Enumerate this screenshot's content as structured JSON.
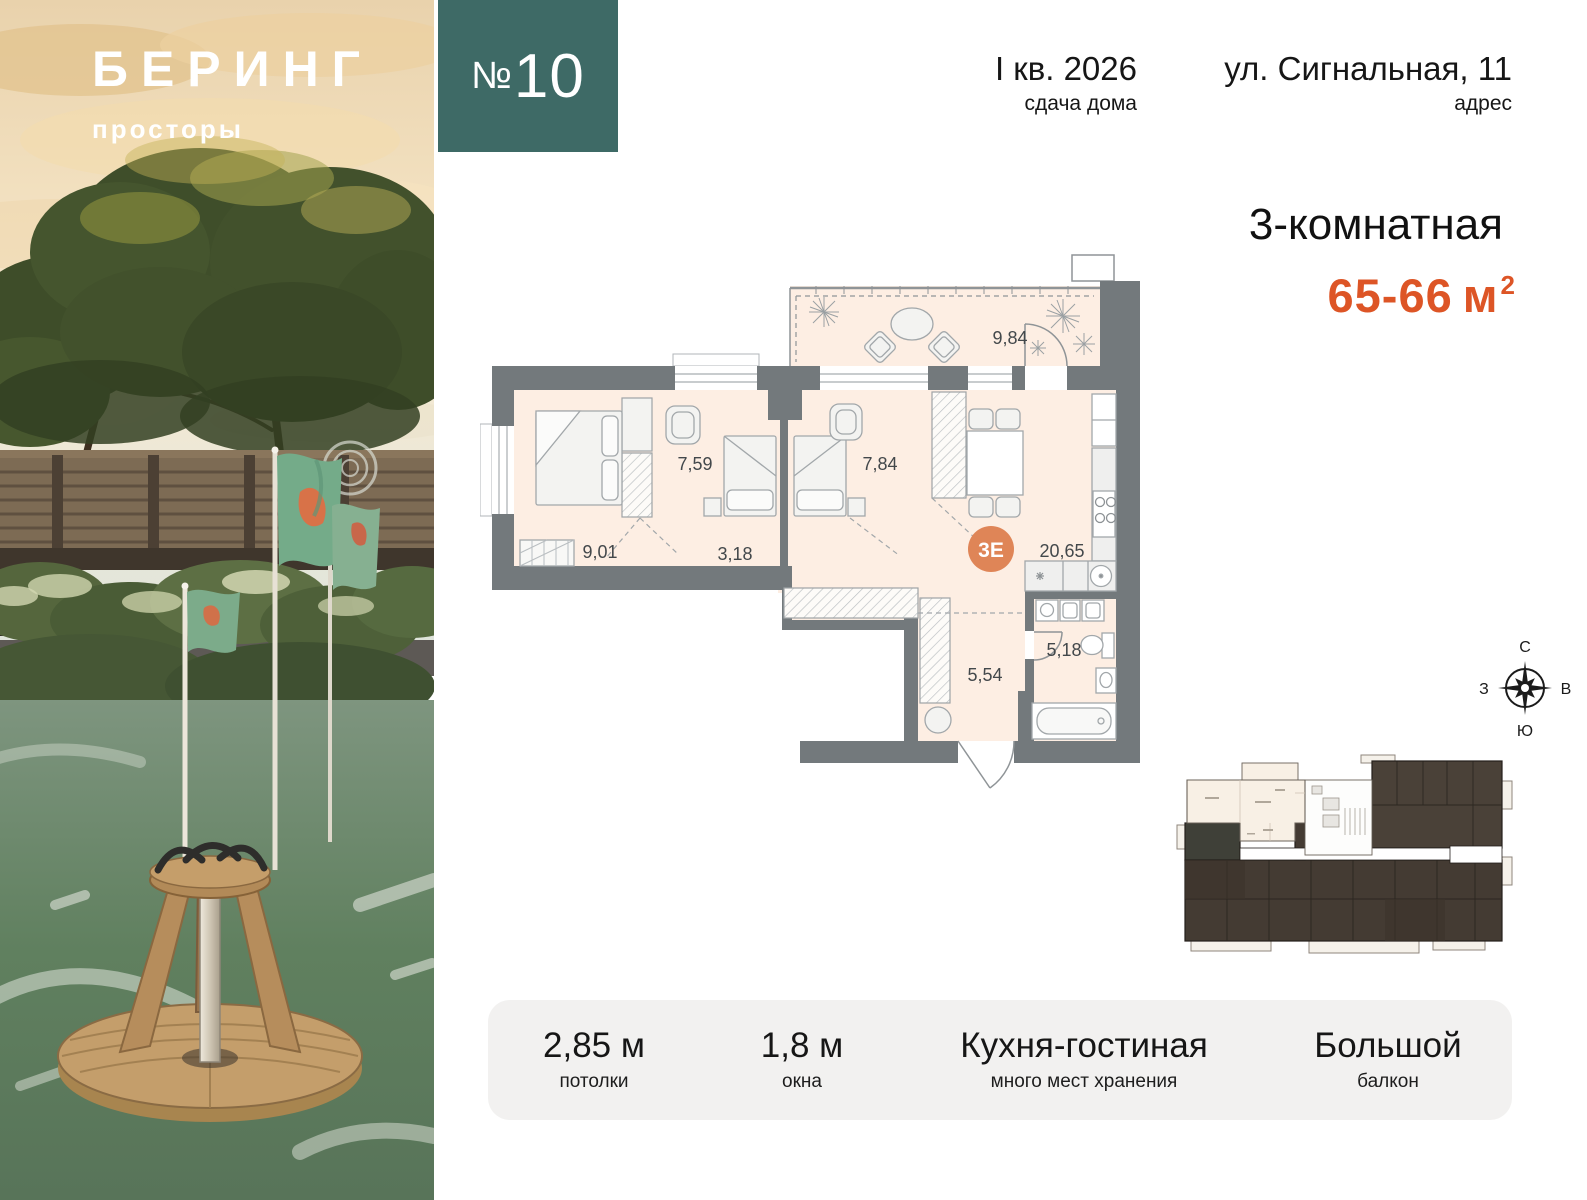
{
  "brand": {
    "name": "БЕРИНГ",
    "subtitle": "просторы"
  },
  "badge": {
    "number_sign": "№",
    "number": "10"
  },
  "header": {
    "completion": {
      "value": "I кв. 2026",
      "label": "сдача дома"
    },
    "address": {
      "value": "ул. Сигнальная, 11",
      "label": "адрес"
    }
  },
  "apartment": {
    "type": "3-комнатная",
    "area_value": "65-66",
    "area_unit": "м",
    "area_superscript": "2"
  },
  "floor_plan": {
    "unit_code": "3Е",
    "areas": {
      "balcony": "9,84",
      "bedroom_left": "9,01",
      "bedroom_mid": "7,59",
      "bedroom_right": "7,84",
      "corridor": "3,18",
      "kitchen_living": "20,65",
      "hallway": "5,54",
      "bathroom": "5,18"
    }
  },
  "compass": {
    "north": "С",
    "east": "В",
    "south": "Ю",
    "west": "З"
  },
  "specs": [
    {
      "value": "2,85 м",
      "label": "потолки"
    },
    {
      "value": "1,8 м",
      "label": "окна"
    },
    {
      "value": "Кухня-гостиная",
      "label": "много мест хранения"
    },
    {
      "value": "Большой",
      "label": "балкон"
    }
  ],
  "colors": {
    "accent_teal": "#3e6a66",
    "accent_orange": "#dd5526",
    "plan_room_fill": "#fdeee3",
    "plan_wall": "#73797c",
    "unit_marker_fill": "#df8557"
  }
}
